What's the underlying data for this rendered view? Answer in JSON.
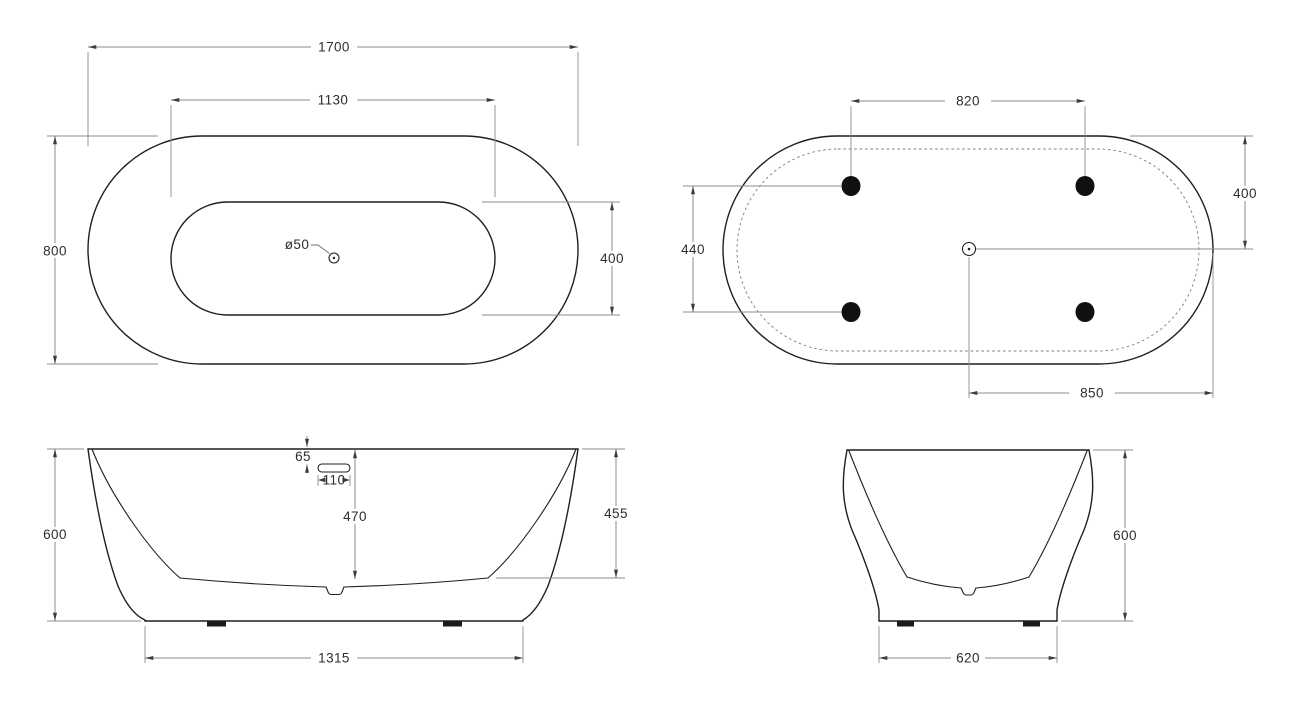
{
  "top_view": {
    "overall_length": "1700",
    "inner_length": "1130",
    "overall_width": "800",
    "inner_width": "400",
    "drain_diameter": "ø50"
  },
  "bottom_view": {
    "feet_spacing_length": "820",
    "feet_spacing_width": "440",
    "drain_to_edge_width": "400",
    "drain_to_edge_length": "850"
  },
  "front_view": {
    "overall_height": "600",
    "overflow_offset": "65",
    "overflow_width": "110",
    "depth_center": "470",
    "depth_side": "455",
    "base_length": "1315"
  },
  "side_view": {
    "overall_height": "600",
    "base_width": "620"
  }
}
